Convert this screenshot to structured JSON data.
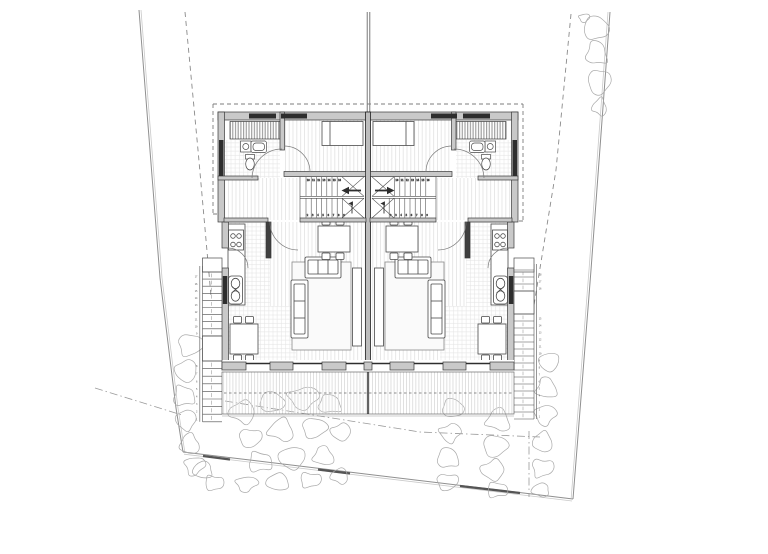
{
  "document": {
    "type": "architectural-floor-plan",
    "subject": "semi-detached twin house, entry level with site plan",
    "visible_text": "none (only tiny stair tread numbers)"
  },
  "colors": {
    "background": "#ffffff",
    "wall_fill": "#c9c9c9",
    "wall_dark": "#2e2e2e",
    "line": "#3a3a3a",
    "line_mid": "#6b6b6b",
    "floor_stripe": "#dedede",
    "tile_grid": "#e3e3e3",
    "deck_stripe": "#d4d4d4",
    "rock": "#a9a9a9",
    "boundary": "#8f8f8f",
    "dashed": "#8a8a8a",
    "rug_fill": "#fafafa",
    "furniture_stroke": "#4a4a4a"
  },
  "plan": {
    "units": [
      {
        "id": "left",
        "rooms": [
          "bathroom",
          "bedroom",
          "hall",
          "stair",
          "kitchen",
          "dining",
          "living",
          "terrace"
        ]
      },
      {
        "id": "right",
        "rooms": [
          "bathroom",
          "bedroom",
          "hall",
          "stair",
          "kitchen",
          "dining",
          "living",
          "terrace"
        ]
      }
    ],
    "site_features": [
      "plot-boundary",
      "setback-dashed-lines",
      "roof-overhang-dashed-outline",
      "rocks",
      "exterior-stairs",
      "terrace-deck",
      "chimney-flue-line"
    ]
  },
  "drawing": {
    "rocks": [
      [
        596,
        28,
        15,
        14
      ],
      [
        584,
        18,
        6,
        5
      ],
      [
        597,
        53,
        13,
        14
      ],
      [
        599,
        82,
        13,
        15
      ],
      [
        600,
        107,
        9,
        10
      ],
      [
        190,
        345,
        14,
        13
      ],
      [
        186,
        371,
        13,
        13
      ],
      [
        184,
        396,
        13,
        12
      ],
      [
        186,
        420,
        12,
        12
      ],
      [
        190,
        444,
        12,
        12
      ],
      [
        194,
        466,
        11,
        11
      ],
      [
        203,
        470,
        12,
        10
      ],
      [
        214,
        483,
        11,
        9
      ],
      [
        243,
        412,
        16,
        13
      ],
      [
        272,
        402,
        15,
        12
      ],
      [
        303,
        398,
        17,
        13
      ],
      [
        330,
        404,
        14,
        11
      ],
      [
        250,
        438,
        13,
        11
      ],
      [
        282,
        430,
        16,
        13
      ],
      [
        314,
        428,
        14,
        12
      ],
      [
        341,
        432,
        12,
        10
      ],
      [
        260,
        462,
        14,
        12
      ],
      [
        292,
        458,
        16,
        13
      ],
      [
        324,
        456,
        13,
        11
      ],
      [
        246,
        484,
        12,
        9
      ],
      [
        278,
        482,
        14,
        10
      ],
      [
        310,
        480,
        12,
        9
      ],
      [
        340,
        476,
        11,
        9
      ],
      [
        453,
        408,
        13,
        11
      ],
      [
        450,
        433,
        12,
        11
      ],
      [
        448,
        458,
        13,
        12
      ],
      [
        447,
        482,
        12,
        10
      ],
      [
        499,
        420,
        15,
        13
      ],
      [
        495,
        446,
        14,
        13
      ],
      [
        493,
        470,
        14,
        12
      ],
      [
        497,
        490,
        12,
        9
      ],
      [
        549,
        362,
        12,
        11
      ],
      [
        547,
        388,
        13,
        12
      ],
      [
        545,
        415,
        12,
        12
      ],
      [
        543,
        442,
        12,
        12
      ],
      [
        542,
        468,
        12,
        11
      ],
      [
        541,
        490,
        11,
        8
      ]
    ],
    "ext_stairs": [
      {
        "x": 202.5,
        "w": 19.5,
        "rails": [
          199.8,
          202.5
        ],
        "num_x": 197.5,
        "num_anchor": "end",
        "porch": [
          258,
          272
        ],
        "landing": [
          336,
          361
        ],
        "flights": [
          {
            "y": 272,
            "n": 9,
            "dy": 7.1
          },
          {
            "y": 361,
            "n": 8,
            "dy": 7.6
          }
        ],
        "total": 17
      },
      {
        "x": 514,
        "w": 20,
        "rails": [
          534,
          536.6
        ],
        "num_x": 538.6,
        "num_anchor": "start",
        "porch": [
          258,
          272
        ],
        "landing": [
          291,
          314
        ],
        "flights": [
          {
            "y": 270,
            "n": 3,
            "dy": 7.0
          },
          {
            "y": 314,
            "n": 15,
            "dy": 7.0
          }
        ],
        "total": 18
      }
    ],
    "int_stair_treads": [
      {
        "x": 306,
        "dx": 5.2,
        "n": 7,
        "y1": 177,
        "y2": 196,
        "num_y": 181,
        "start": 10
      },
      {
        "x": 306,
        "dx": 5.2,
        "n": 8,
        "y1": 198.5,
        "y2": 217.5,
        "num_y": 215.8,
        "start": 2
      },
      {
        "x": 394.6,
        "dx": 5.2,
        "n": 7,
        "y1": 177,
        "y2": 196,
        "num_y": 181,
        "start": 10
      },
      {
        "x": 389.2,
        "dx": 5.2,
        "n": 8,
        "y1": 198.5,
        "y2": 217.5,
        "num_y": 215.8,
        "start": 2
      }
    ]
  }
}
